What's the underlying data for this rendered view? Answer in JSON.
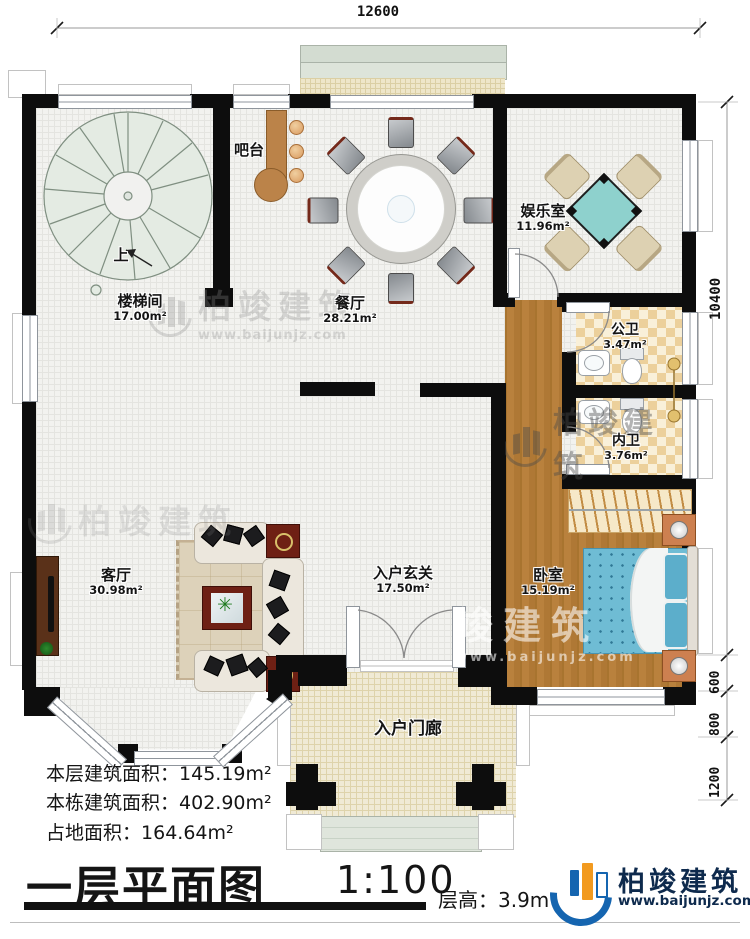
{
  "dimensions": {
    "top_width": "12600",
    "right_height": "10400",
    "right_seg1": "600",
    "right_seg2": "800",
    "right_seg3": "1200"
  },
  "rooms": {
    "stairwell": {
      "name": "楼梯间",
      "area": "17.00m²",
      "direction": "上"
    },
    "bar": {
      "name": "吧台"
    },
    "dining": {
      "name": "餐厅",
      "area": "28.21m²"
    },
    "entertainment": {
      "name": "娱乐室",
      "area": "11.96m²"
    },
    "public_bath": {
      "name": "公卫",
      "area": "3.47m²"
    },
    "inner_bath": {
      "name": "内卫",
      "area": "3.76m²"
    },
    "living": {
      "name": "客厅",
      "area": "30.98m²"
    },
    "foyer": {
      "name": "入户玄关",
      "area": "17.50m²"
    },
    "bedroom": {
      "name": "卧室",
      "area": "15.19m²"
    },
    "porch": {
      "name": "入户门廊"
    }
  },
  "stats": {
    "floor_area": {
      "label": "本层建筑面积：",
      "value": "145.19m²"
    },
    "total_area": {
      "label": "本栋建筑面积：",
      "value": "402.90m²"
    },
    "land_area": {
      "label": "占地面积：",
      "value": "164.64m²"
    }
  },
  "titleblock": {
    "title": "一层平面图",
    "scale": "1:100",
    "storey_label": "层高：",
    "storey_value": "3.9m"
  },
  "brand": {
    "name": "柏竣建筑",
    "site": "www.baijunjz.com"
  },
  "watermark": {
    "name": "柏竣建筑",
    "site": "www.baijunjz.com",
    "partial": "竣建筑"
  },
  "icons": {
    "plant": "✳"
  },
  "colors": {
    "wall": "#0d0d0d",
    "wood_floor": "#b07a3c",
    "tile_dark": "#ecd09b",
    "tile_light": "#f9f0d9",
    "mattress_teal": "#6fbcd4",
    "mahjong_teal": "#8ed1cd",
    "brand_blue": "#1565b0",
    "brand_orange": "#f29a1f",
    "brand_navy": "#0e2a4d"
  }
}
